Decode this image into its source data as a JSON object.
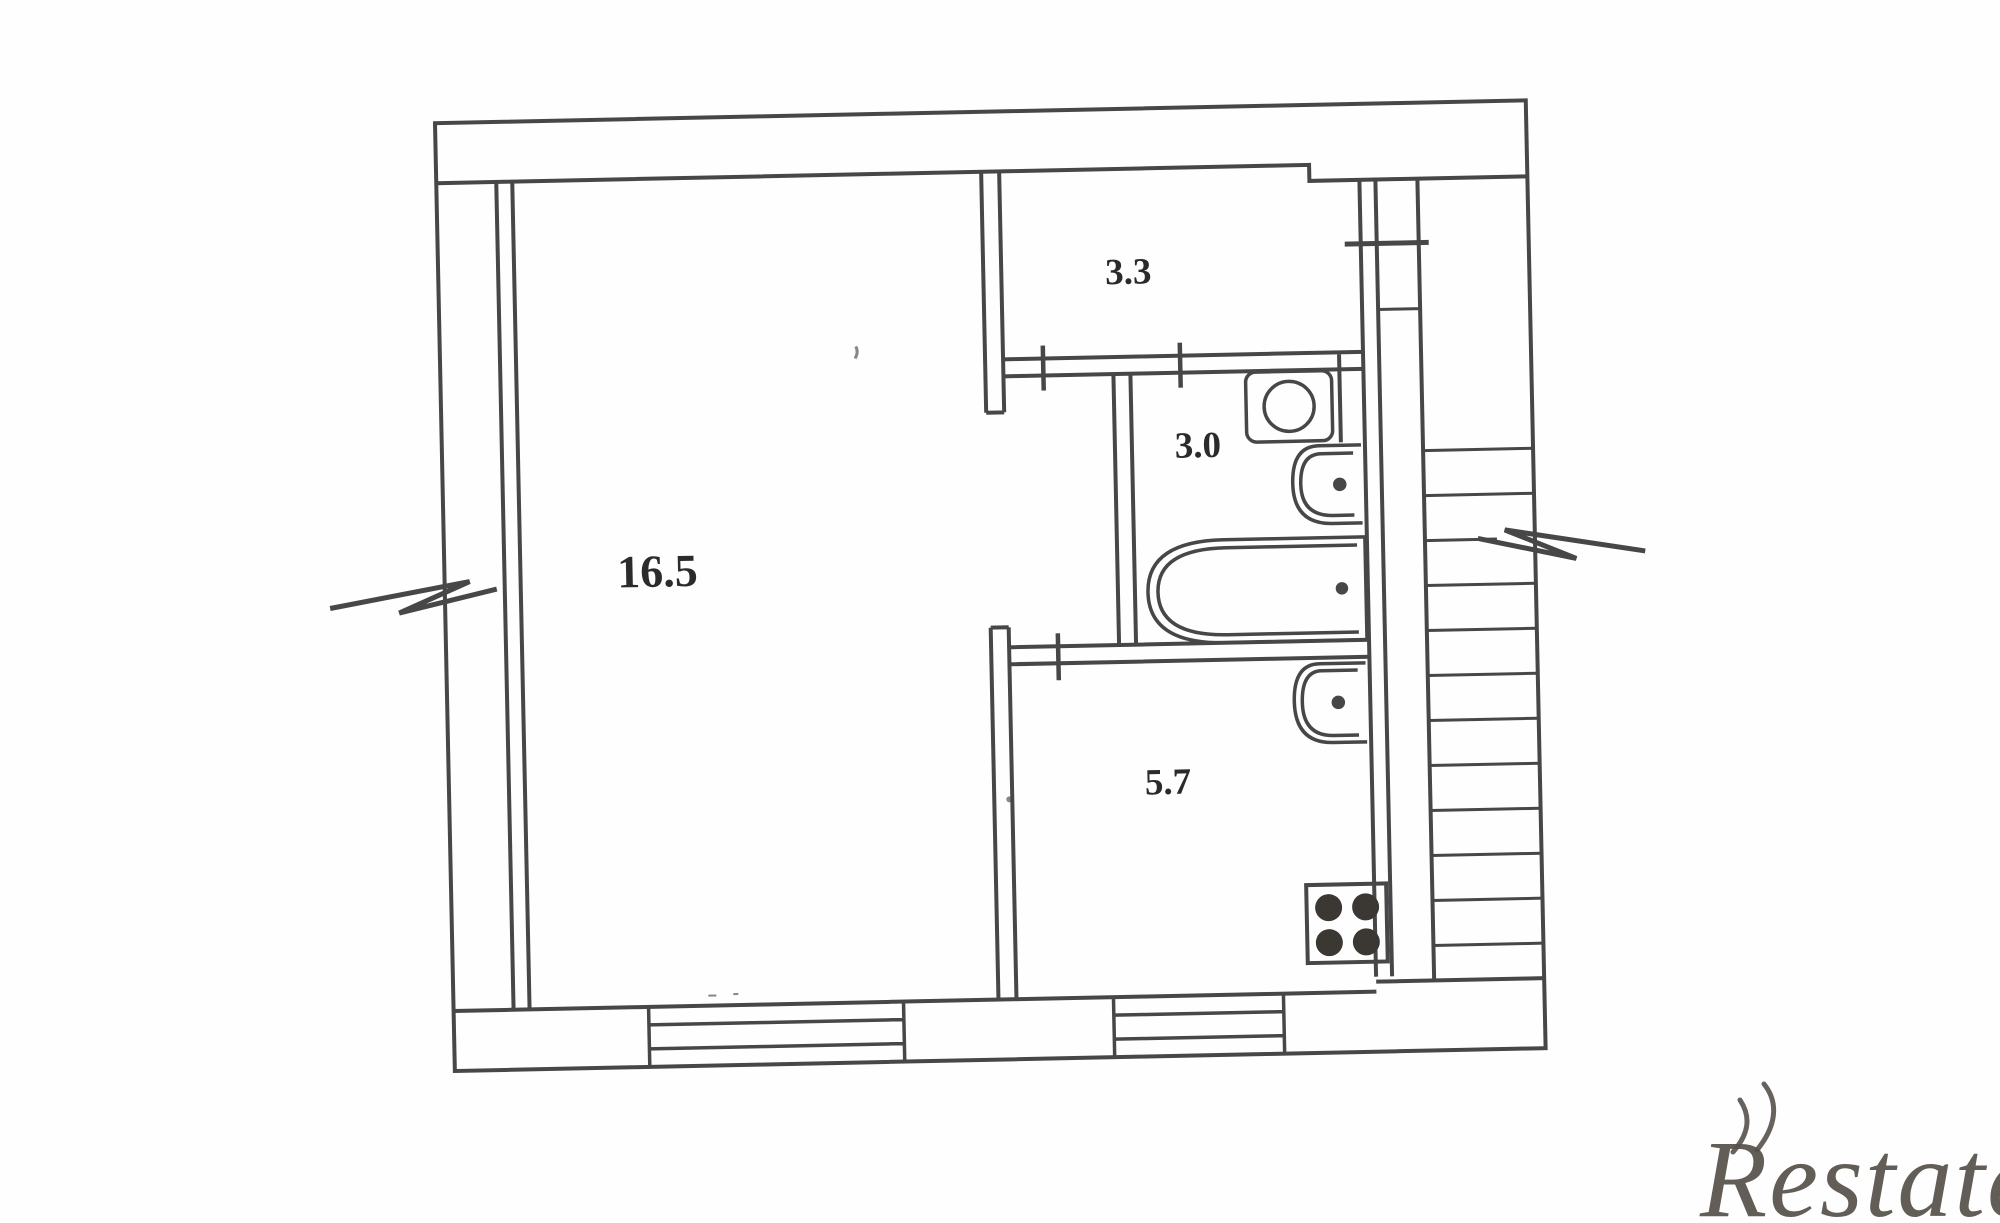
{
  "plan": {
    "rooms": [
      {
        "name": "living-room",
        "area": "16.5"
      },
      {
        "name": "hallway",
        "area": "3.3"
      },
      {
        "name": "bathroom",
        "area": "3.0"
      },
      {
        "name": "kitchen",
        "area": "5.7"
      }
    ],
    "fixtures": [
      "toilet",
      "washbasin",
      "bathtub",
      "kitchen-sink",
      "stove-4-burner"
    ],
    "features": [
      "staircase",
      "window",
      "window",
      "wall-break-mark-left",
      "wall-break-mark-right",
      "door-openings"
    ],
    "colors": {
      "line": "#474747",
      "label": "#2b2b2b",
      "burners": "#3b3733",
      "watermark": "#57514b"
    }
  },
  "watermark": {
    "text": "Restate"
  }
}
